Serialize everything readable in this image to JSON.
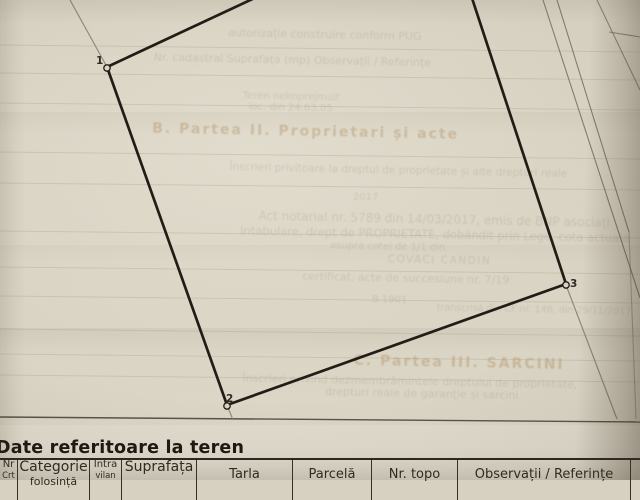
{
  "heading": {
    "text": "Date referitoare la teren"
  },
  "table": {
    "columns": [
      {
        "label": "Nr",
        "sub": "Crt",
        "width": 18,
        "size": 10,
        "sub_size": 8.5,
        "two_line": true
      },
      {
        "label": "Categorie",
        "sub": "folosință",
        "width": 72,
        "size": 14,
        "sub_size": 11,
        "two_line": true
      },
      {
        "label": "Intra",
        "sub": "vilan",
        "width": 32,
        "size": 10,
        "sub_size": 8.5,
        "two_line": true
      },
      {
        "label": "Suprafața",
        "sub": "",
        "width": 75,
        "size": 14,
        "sub_size": 11,
        "two_line": true
      },
      {
        "label": "Tarla",
        "sub": "",
        "width": 96,
        "size": 13,
        "sub_size": 0,
        "two_line": false
      },
      {
        "label": "Parcelă",
        "sub": "",
        "width": 79,
        "size": 13,
        "sub_size": 0,
        "two_line": false
      },
      {
        "label": "Nr. topo",
        "sub": "",
        "width": 86,
        "size": 13,
        "sub_size": 0,
        "two_line": false
      },
      {
        "label": "Observații / Referințe",
        "sub": "",
        "width": 173,
        "size": 13,
        "sub_size": 0,
        "two_line": false
      }
    ]
  },
  "sketch": {
    "vertices": [
      {
        "label": "1",
        "cx": 107,
        "cy": 68,
        "lx": 96,
        "ly": 64
      },
      {
        "label": "2",
        "cx": 227,
        "cy": 406,
        "lx": 226,
        "ly": 402
      },
      {
        "label": "3",
        "cx": 566,
        "cy": 285,
        "lx": 570,
        "ly": 287
      }
    ],
    "edges": [
      {
        "x1": 107,
        "y1": 67,
        "x2": 227,
        "y2": 405
      },
      {
        "x1": 227,
        "y1": 405,
        "x2": 566,
        "y2": 284
      },
      {
        "x1": 566,
        "y1": 284,
        "x2": 443,
        "y2": -90
      },
      {
        "x1": 107,
        "y1": 67,
        "x2": 443,
        "y2": -90
      }
    ],
    "extensions": [
      {
        "x1": 70,
        "y1": 0,
        "x2": 107,
        "y2": 67
      },
      {
        "x1": 227,
        "y1": 405,
        "x2": 233,
        "y2": 420
      },
      {
        "x1": 566,
        "y1": 285,
        "x2": 617,
        "y2": 419
      }
    ],
    "neighbor_lines": [
      {
        "x1": 543,
        "y1": 0,
        "x2": 640,
        "y2": 298,
        "o": 0.8
      },
      {
        "x1": 557,
        "y1": 0,
        "x2": 629,
        "y2": 232,
        "o": 0.8
      },
      {
        "x1": 629,
        "y1": 232,
        "x2": 636,
        "y2": 419,
        "o": 0.45
      },
      {
        "x1": 597,
        "y1": 0,
        "x2": 640,
        "y2": 90,
        "o": 0.7
      },
      {
        "x1": 609,
        "y1": 32,
        "x2": 640,
        "y2": 37,
        "o": 0.7
      }
    ],
    "baseline": {
      "x1": 0,
      "y1": 417,
      "x2": 640,
      "y2": 422
    },
    "faint_rule_y": [
      45,
      73,
      103,
      152,
      183,
      231,
      267,
      296,
      329,
      354,
      375
    ]
  },
  "show_through": {
    "lines": [
      {
        "text": "autorizație construire conform PUG",
        "x": 224,
        "y": 28,
        "size": 11,
        "accent": false,
        "bold": false,
        "ls": 0
      },
      {
        "text": "Nr. cadastral      Suprafața (mp)      Observații / Referințe",
        "x": 150,
        "y": 54,
        "size": 11,
        "accent": false,
        "bold": false,
        "ls": 0
      },
      {
        "text": "Teren neîmprejmuit",
        "x": 240,
        "y": 92,
        "size": 10,
        "accent": false,
        "bold": false,
        "ls": 0
      },
      {
        "text": "loc. din 24.03.05",
        "x": 246,
        "y": 103,
        "size": 10,
        "accent": false,
        "bold": false,
        "ls": 0
      },
      {
        "text": "B.   Partea II.   Proprietari și acte",
        "x": 150,
        "y": 124,
        "size": 14,
        "accent": true,
        "bold": true,
        "ls": 2
      },
      {
        "text": "Înscrieri privitoare la dreptul de proprietate și alte drepturi reale",
        "x": 228,
        "y": 163,
        "size": 10.5,
        "accent": false,
        "bold": false,
        "ls": 0
      },
      {
        "text": "2017",
        "x": 352,
        "y": 191,
        "size": 10,
        "accent": false,
        "bold": false,
        "ls": 0
      },
      {
        "text": "Act notarial nr. 5789 din 14/03/2017, emis de BNP asociați",
        "x": 258,
        "y": 210,
        "size": 12,
        "accent": false,
        "bold": false,
        "ls": 0
      },
      {
        "text": "Intabulare, drept de PROPRIETATE, dobândit prin Lege, cota actuala",
        "x": 240,
        "y": 225,
        "size": 11.5,
        "accent": false,
        "bold": false,
        "ls": 0
      },
      {
        "text": "asupra cotei de 1/1 din",
        "x": 330,
        "y": 240,
        "size": 10,
        "accent": false,
        "bold": false,
        "ls": 0
      },
      {
        "text": "COVACI CANDIN",
        "x": 388,
        "y": 252,
        "size": 10.5,
        "accent": false,
        "bold": false,
        "ls": 1.5
      },
      {
        "text": "certificat, acte de succesiune nr. 7/19",
        "x": 303,
        "y": 270,
        "size": 11,
        "accent": false,
        "bold": false,
        "ls": 0
      },
      {
        "text": "B 1901",
        "x": 373,
        "y": 293,
        "size": 10,
        "accent": false,
        "bold": false,
        "ls": 0
      },
      {
        "text": "transcrisă din CF nr. 146, din 29/11/2017",
        "x": 438,
        "y": 300,
        "size": 9.5,
        "accent": false,
        "bold": false,
        "ls": 0
      },
      {
        "text": "C.   Partea III.   SARCINI",
        "x": 356,
        "y": 352,
        "size": 14,
        "accent": true,
        "bold": true,
        "ls": 2
      },
      {
        "text": "Înscrieri privind dezmembrămintele dreptului de proprietate,",
        "x": 245,
        "y": 373,
        "size": 11,
        "accent": false,
        "bold": false,
        "ls": 0
      },
      {
        "text": "drepturi reale de garanție și sarcini",
        "x": 328,
        "y": 385,
        "size": 11,
        "accent": false,
        "bold": false,
        "ls": 0
      }
    ]
  },
  "colors": {
    "paper": "#d7d1c1",
    "ink": "#211c16",
    "extension_gray": "#8a8274",
    "neighbor_gray": "#6e675a",
    "baseline_gray": "#4a443b",
    "faint_rule": "#a99f88",
    "table_border": "#36302a",
    "heading_ink": "#1c1812"
  }
}
